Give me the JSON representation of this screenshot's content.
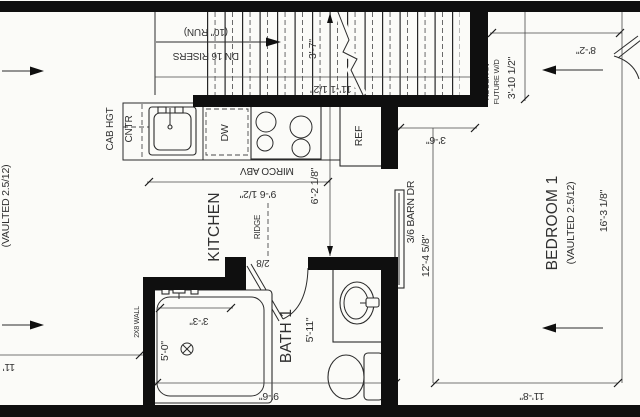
{
  "plan": {
    "stairs": {
      "note1": "DN 16 RISERS",
      "note2": "(10\" RUN)",
      "width_dim": "3'-7\"",
      "run_dim": "11'-1 1/2\""
    },
    "laundry": {
      "name1": "ROUGH-IN",
      "name2": "FUTURE W/D",
      "depth_dim": "3'-10 1/2\"",
      "width_dim": "8'-2\""
    },
    "kitchen": {
      "name": "KITCHEN",
      "cab1": "CAB HGT",
      "cab2": "CNTR",
      "dw": "DW",
      "ref": "REF",
      "micro": "MIRCO ABV",
      "width_dim": "9'-6 1/2\"",
      "depth_dim": "6'-2 1/8\"",
      "ridge": "RIDGE"
    },
    "bath": {
      "name": "BATH 1",
      "length_dim": "5'-11\"",
      "width_dim": "9'-6\"",
      "door": "2/8",
      "tub_width_dim": "3'-3\"",
      "tub_length_dim": "5'-0\"",
      "wall": "2X8 WALL"
    },
    "bedroom": {
      "name": "BEDROOM 1",
      "vault": "(VAULTED 2.5/12)",
      "length_dim": "16'-3 1/8\"",
      "width_dim": "11'-8\"",
      "hall_dim": "3'-6\"",
      "barn_door": "3/6 BARN DR",
      "interior_dim": "12'-4 5/8\""
    },
    "living": {
      "vault": "(VAULTED 2.5/12)",
      "partial_dim": "11'"
    }
  }
}
